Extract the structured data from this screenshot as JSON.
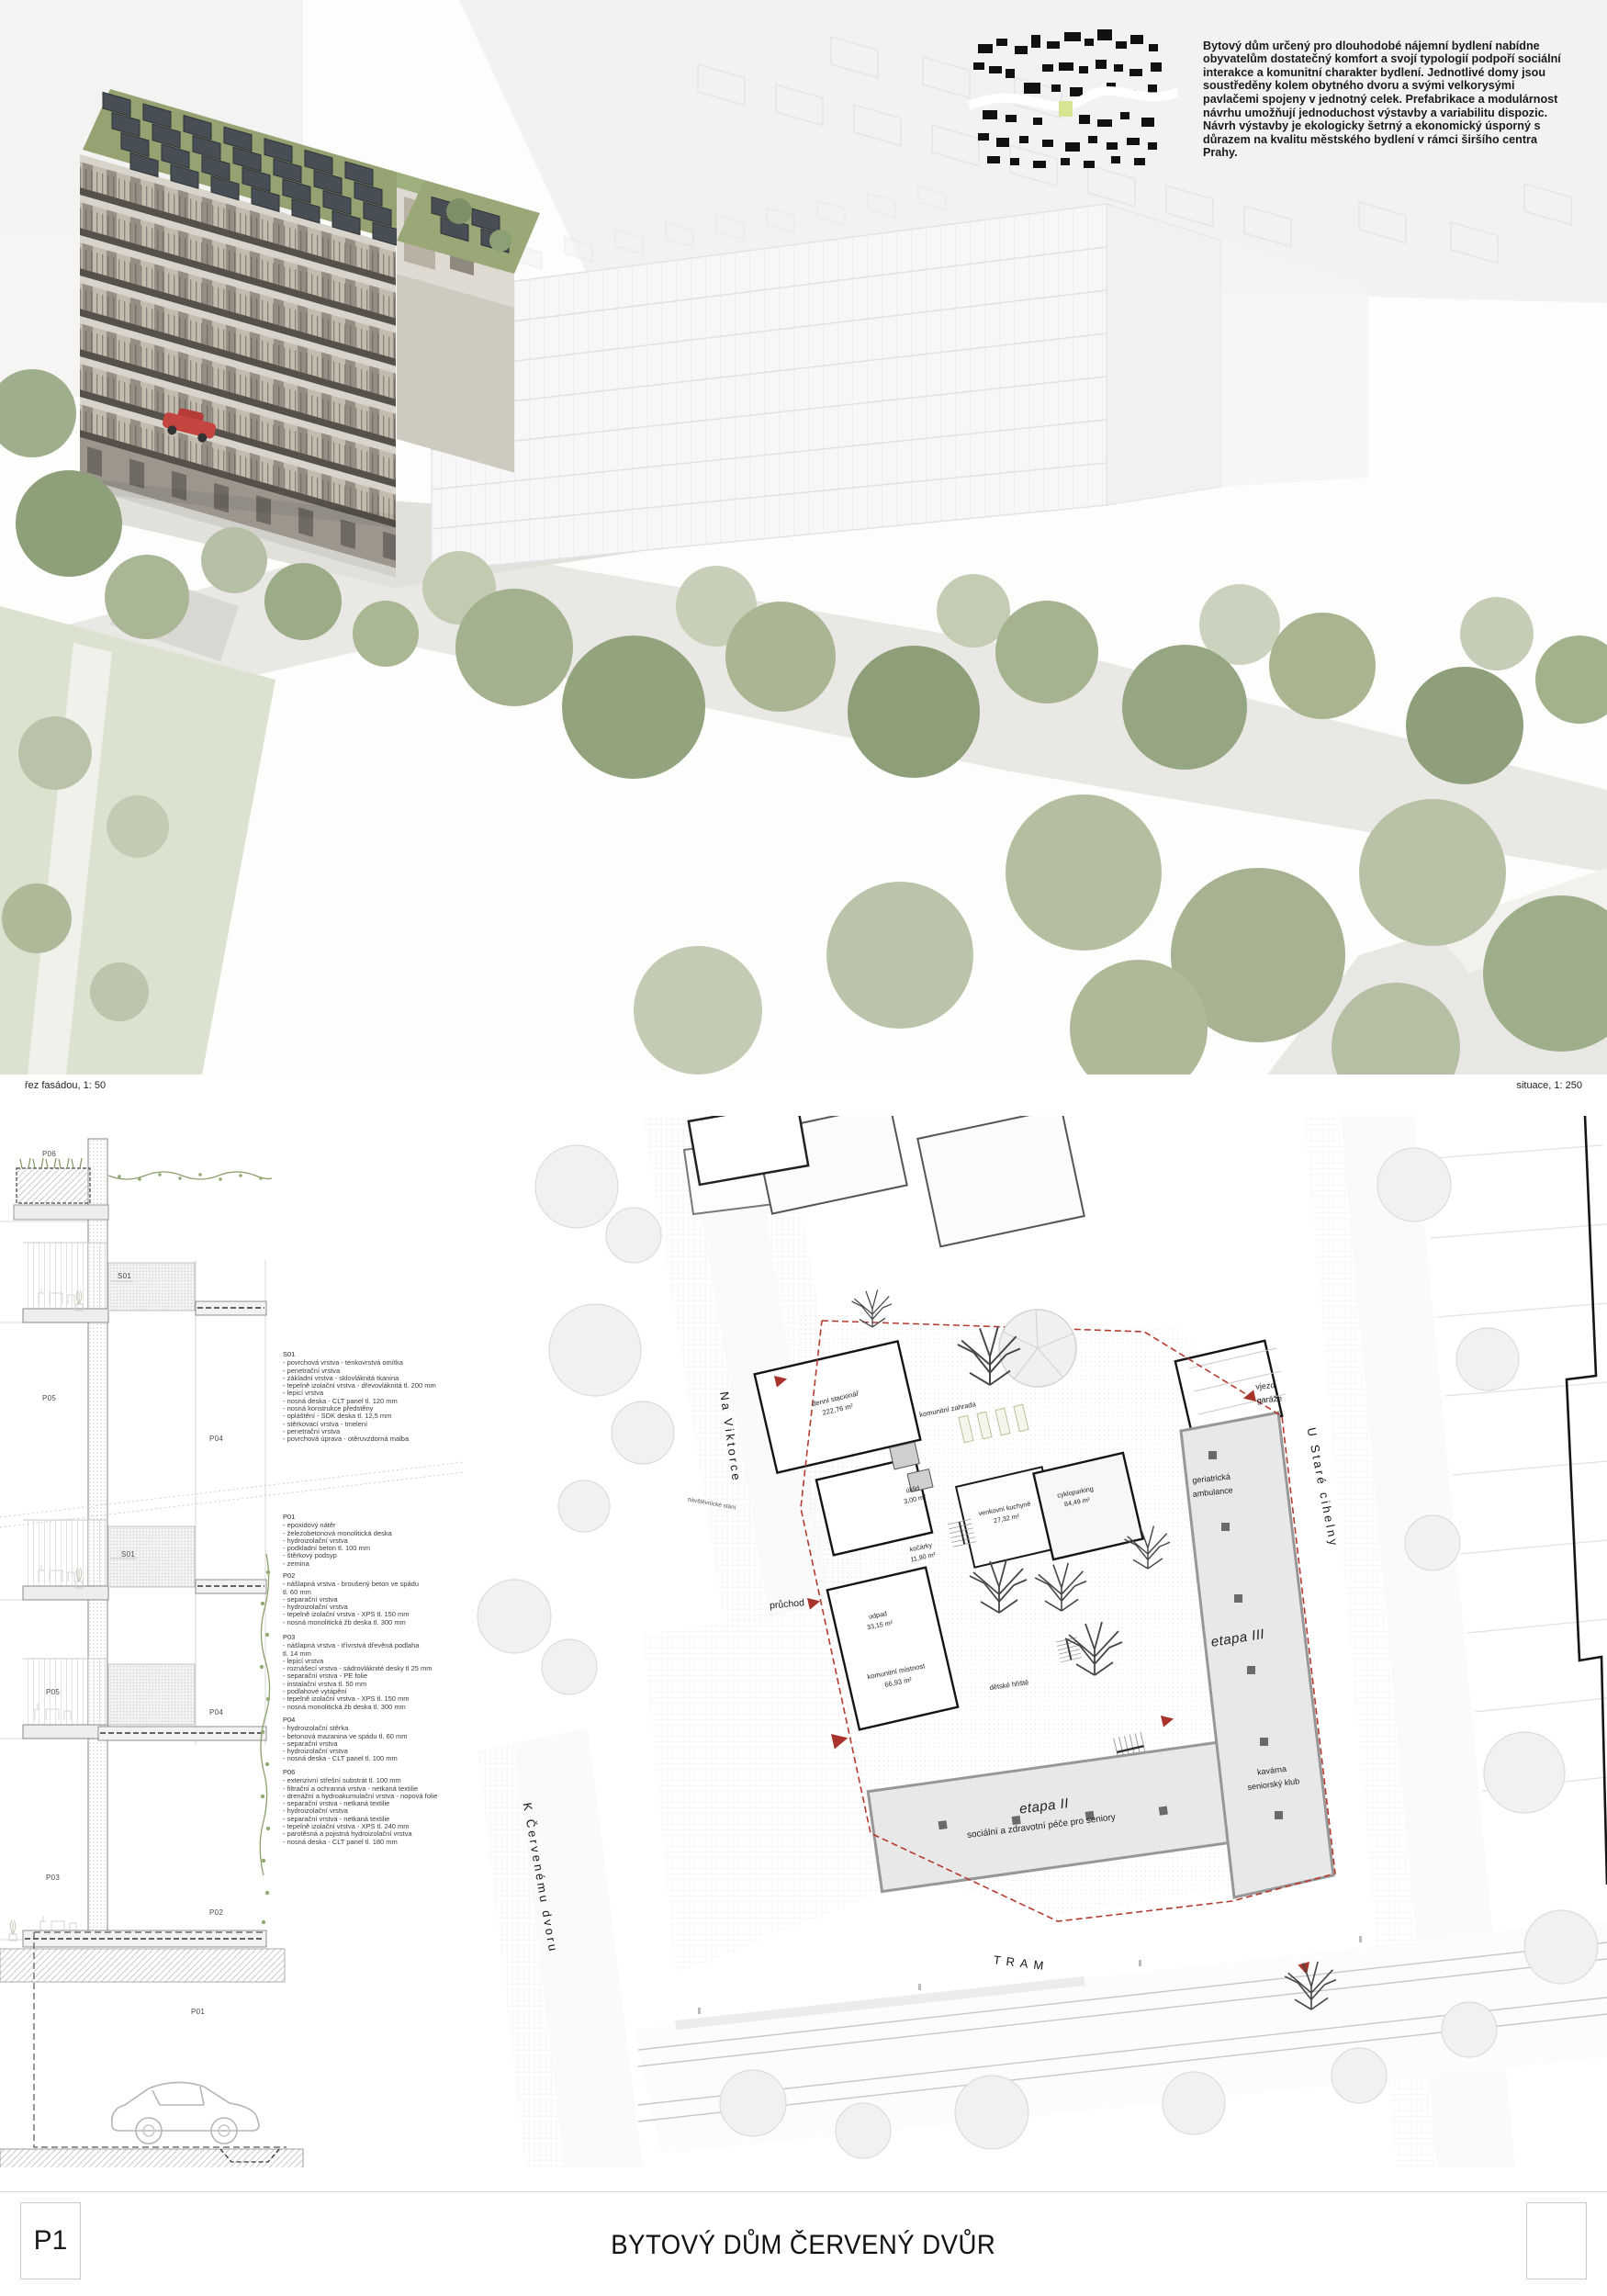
{
  "intro": {
    "text": "Bytový dům určený pro dlouhodobé nájemní bydlení nabídne obyvatelům dostatečný komfort a svojí typologií podpoří sociální interakce a komunitní charakter bydlení. Jednotlivé domy jsou soustředěny kolem obytného dvoru a svými velkorysými pavlačemi spojeny v jednotný celek. Prefabrikace a modulárnost návrhu umožňují jednoduchost výstavby a variabilitu dispozic. Návrh výstavby je ekologicky šetrný a ekonomický úsporný s důrazem na kvalitu městského bydlení v rámci širšího centra Prahy."
  },
  "labels": {
    "section_scale": "řez fasádou, 1: 50",
    "siteplan_scale": "situace, 1: 250"
  },
  "section": {
    "markers": [
      "P06",
      "S01",
      "P05",
      "P04",
      "S01",
      "P05",
      "P04",
      "P03",
      "P02",
      "P01"
    ],
    "specs": {
      "s01": {
        "title": "S01",
        "lines": [
          "- povrchová vrstva - tenkovrstvá omítka",
          "- penetrační vrstva",
          "- základní vrstva - sklovláknitá tkanina",
          "- tepelně izolační vrstva - dřevovláknitá tl. 200 mm",
          "- lepicí vrstva",
          "- nosná deska - CLT panel tl. 120 mm",
          "- nosná konstrukce předstěny",
          "- opláštění - SDK deska tl. 12,5 mm",
          "- stěrkovací vrstva - tmelení",
          "- penetrační vrstva",
          "- povrchová úprava - otěruvzdorná malba"
        ]
      },
      "p01": {
        "title": "P01",
        "lines": [
          "- epoxidový nátěr",
          "- železobetonová monolitická deska",
          "- hydroizolační vrstva",
          "- podkladní beton tl. 100 mm",
          "- štěrkový podsyp",
          "- zemina"
        ]
      },
      "p02": {
        "title": "P02",
        "lines": [
          "- nášlapná vrstva - broušený beton ve spádu",
          "tl. 60 mm",
          "- separační vrstva",
          "- hydroizolační vrstva",
          "- tepelně izolační vrstva - XPS tl. 150 mm",
          "- nosná monolitická žb deska tl. 300 mm"
        ]
      },
      "p03": {
        "title": "P03",
        "lines": [
          "- nášlapná vrstva - třívrstvá dřevěná podlaha",
          "tl. 14 mm",
          "- lepicí vrstva",
          "- roznášecí vrstva - sádrovláknité desky tl 25 mm",
          "- separační vrstva - PE folie",
          "- instalační vrstva tl. 50 mm",
          "    - podlahové vytápění",
          "- tepelně izolační vrstva - XPS tl. 150 mm",
          "- nosná monolitická žb deska tl. 300 mm"
        ]
      },
      "p04": {
        "title": "P04",
        "lines": [
          "- hydroizolační stěrka",
          "- betonová mazanina ve spádu tl. 60 mm",
          "- separační vrstva",
          "- hydroizolační vrstva",
          "- nosná deska - CLT panel tl. 100 mm"
        ]
      },
      "p06": {
        "title": "P06",
        "lines": [
          "- extenzivní střešní substrát tl. 100 mm",
          "- filtrační a ochranná vrstva - netkaná textilie",
          "- drenážní a hydroakumulační vrstva - nopová folie",
          "- separační vrstva - netkaná textilie",
          "- hydroizolační vrstva",
          "- separační vrstva - netkaná textilie",
          "- tepelně izolační vrstva - XPS tl. 240 mm",
          "- parotěsná a pojistná hydroizolační vrstva",
          "- nosná deska - CLT panel tl. 180 mm"
        ]
      }
    }
  },
  "site_plan": {
    "streets": {
      "na_viktorce": "Na Viktorce",
      "u_stare_cihelny": "U Staré cihelny",
      "k_cervenemu_dvoru": "K Červenému dvoru",
      "tram": "TRAM"
    },
    "labels": {
      "navstevnicke_stani": "návštěvnické stání",
      "pruchod": "průchod",
      "vjezd_garaze": "vjezd garáže",
      "komunitni_zahrada": "komunitní zahrada",
      "detske_hriste": "dětské hřiště",
      "geriatricka_ambulance": "geriatrická ambulance",
      "kavarna_line1": "kavárna",
      "kavarna_line2": "seniorský klub",
      "etapa2": "etapa II",
      "etapa2_sub": "sociální a zdravotní péče pro seniory",
      "etapa3": "etapa III"
    },
    "rooms": {
      "denni_stacionar": {
        "name": "denní stacionář",
        "area": "222,76 m²"
      },
      "uklid": {
        "name": "úklid",
        "area": "3,00 m²"
      },
      "kocarky": {
        "name": "kočárky",
        "area": "11,90 m²"
      },
      "venkovni_kuchyne": {
        "name": "venkovní kuchyně",
        "area": "27,32 m²"
      },
      "cykloparking": {
        "name": "cykloparking",
        "area": "84,49 m²"
      },
      "odpad": {
        "name": "odpad",
        "area": "33,15 m²"
      },
      "komunitni_mistnost": {
        "name": "komunitní místnost",
        "area": "66,93 m²"
      }
    }
  },
  "footer": {
    "panel_id": "P1",
    "title": "BYTOVÝ DŮM ČERVENÝ DVŮR"
  },
  "colors": {
    "accent_red": "#a8332a",
    "boundary_red": "#b43b30",
    "map_highlight_green": "#d9e394",
    "greenery": "#9aa885",
    "solar_panel": "#474e54"
  }
}
